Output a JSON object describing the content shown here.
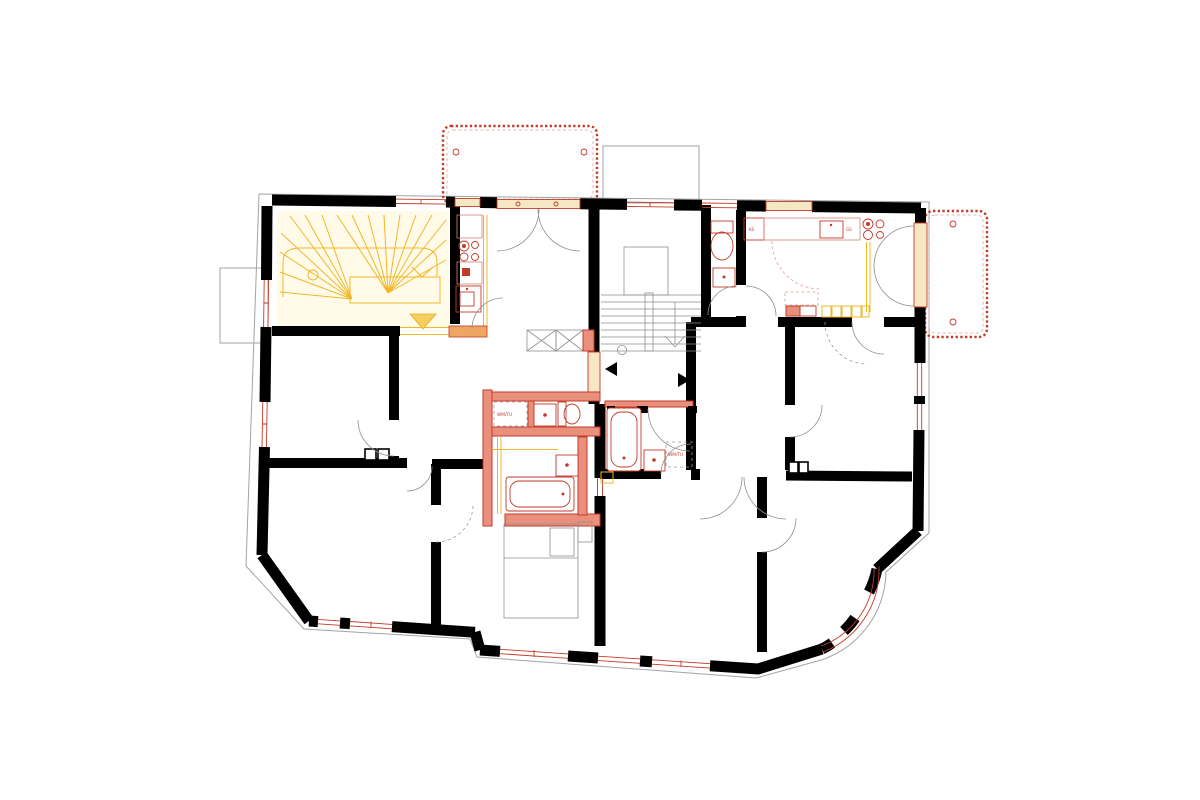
{
  "drawing": {
    "kind": "architectural floor plan, renovation phase drawing",
    "background": "#ffffff"
  },
  "labels": {
    "washer_dryer": "WM/TU",
    "fridge": "KS",
    "dishwasher": "GS"
  },
  "colors": {
    "existing_wall": "#000000",
    "facade_line": "#a3a3a3",
    "demolition_yellow": "#f0b72a",
    "demolition_fill": "#fffbe8",
    "new_construction_red": "#c23a28",
    "new_wall_fill": "#e9907c",
    "new_opening_fill": "#f6e7c4",
    "fixture_gray": "#8f8f8f"
  },
  "elements": {
    "stairs": [
      "winder-stair-demolition",
      "main-straight-stair"
    ],
    "balconies": [
      "balcony-top-dashed",
      "balcony-right-dashed"
    ],
    "fixtures": [
      "toilet",
      "bathtub",
      "washbasin",
      "washing-machine",
      "stove",
      "kitchen-sink",
      "refrigerator",
      "bed",
      "duct-shaft",
      "chimney"
    ],
    "symbols": [
      "entry-arrow-left",
      "entry-arrow-right",
      "down-arrow",
      "door-swing"
    ]
  }
}
